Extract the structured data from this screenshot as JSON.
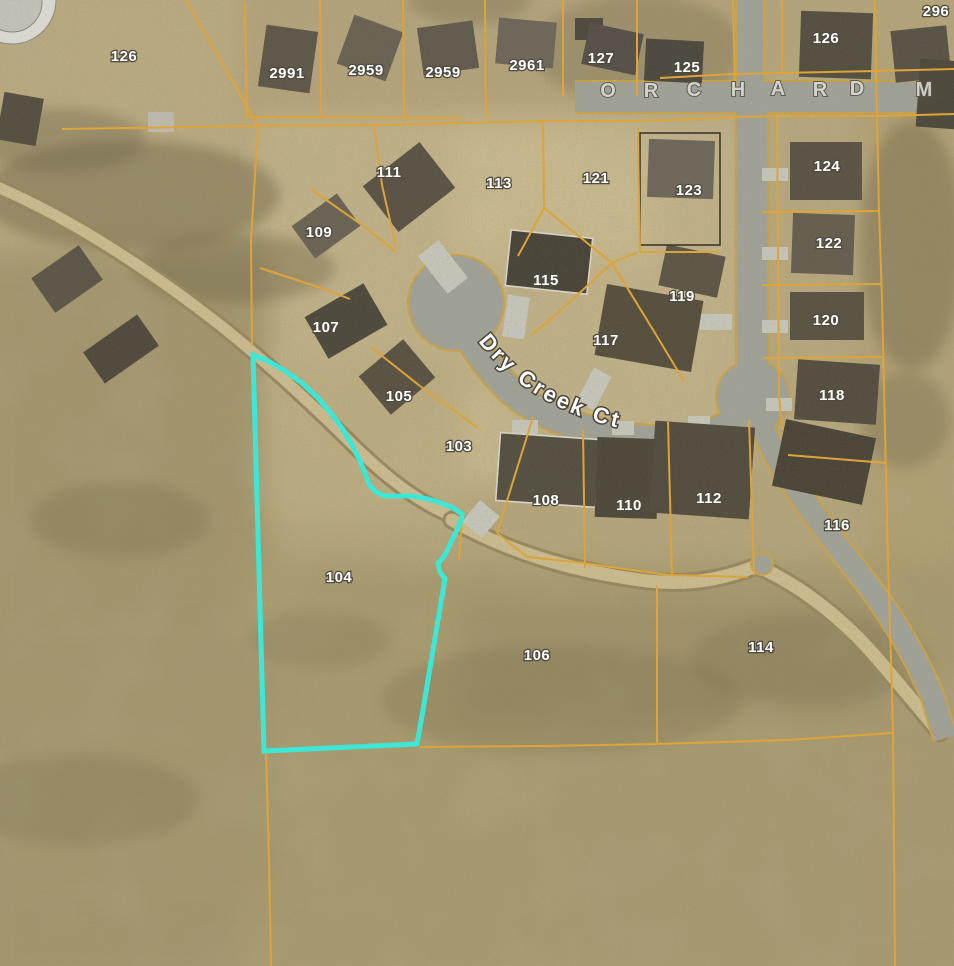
{
  "map": {
    "title": "Aerial parcel map",
    "highlight_parcel": "104",
    "street_names": {
      "court": "Dry Creek Ct",
      "main_road_visible": "O R C H A R D  M"
    },
    "colors": {
      "terrain": "#b3a47a",
      "parcel_line": "#dca43a",
      "highlight": "#3ee6d6",
      "road": "#a0a196",
      "road_edge": "#c9a24a",
      "trail_dark": "#97885f",
      "trail_light": "#c9ba8e",
      "label": "#ffffff",
      "label_halo": "#4e4a3e"
    },
    "parcel_labels": [
      {
        "text": "126",
        "x": 124,
        "y": 57
      },
      {
        "text": "2991",
        "x": 287,
        "y": 74
      },
      {
        "text": "2959",
        "x": 366,
        "y": 71
      },
      {
        "text": "2959",
        "x": 443,
        "y": 73
      },
      {
        "text": "2961",
        "x": 527,
        "y": 66
      },
      {
        "text": "127",
        "x": 601,
        "y": 59
      },
      {
        "text": "125",
        "x": 687,
        "y": 68
      },
      {
        "text": "126",
        "x": 826,
        "y": 39
      },
      {
        "text": "296",
        "x": 936,
        "y": 12
      },
      {
        "text": "111",
        "x": 389,
        "y": 173
      },
      {
        "text": "113",
        "x": 499,
        "y": 184
      },
      {
        "text": "121",
        "x": 596,
        "y": 179
      },
      {
        "text": "123",
        "x": 689,
        "y": 191
      },
      {
        "text": "124",
        "x": 827,
        "y": 167
      },
      {
        "text": "109",
        "x": 319,
        "y": 233
      },
      {
        "text": "115",
        "x": 546,
        "y": 281
      },
      {
        "text": "119",
        "x": 682,
        "y": 297
      },
      {
        "text": "122",
        "x": 829,
        "y": 244
      },
      {
        "text": "107",
        "x": 326,
        "y": 328
      },
      {
        "text": "117",
        "x": 606,
        "y": 341
      },
      {
        "text": "120",
        "x": 826,
        "y": 321
      },
      {
        "text": "105",
        "x": 399,
        "y": 397
      },
      {
        "text": "103",
        "x": 459,
        "y": 447
      },
      {
        "text": "118",
        "x": 832,
        "y": 396
      },
      {
        "text": "108",
        "x": 546,
        "y": 501
      },
      {
        "text": "110",
        "x": 629,
        "y": 506
      },
      {
        "text": "112",
        "x": 709,
        "y": 499
      },
      {
        "text": "116",
        "x": 837,
        "y": 526
      },
      {
        "text": "104",
        "x": 339,
        "y": 578
      },
      {
        "text": "106",
        "x": 537,
        "y": 656
      },
      {
        "text": "114",
        "x": 761,
        "y": 648
      }
    ],
    "orchard_letters": [
      {
        "ch": "O",
        "x": 608,
        "y": 97
      },
      {
        "ch": "R",
        "x": 651,
        "y": 97
      },
      {
        "ch": "C",
        "x": 694,
        "y": 96
      },
      {
        "ch": "H",
        "x": 738,
        "y": 96
      },
      {
        "ch": "A",
        "x": 778,
        "y": 95
      },
      {
        "ch": "R",
        "x": 820,
        "y": 96
      },
      {
        "ch": "D",
        "x": 857,
        "y": 95
      },
      {
        "ch": "M",
        "x": 924,
        "y": 96
      }
    ],
    "highlight_outline_points": "253,355 268,361 285,371 302,383 317,397 330,412 342,428 352,445 360,461 366,476 370,486 376,492 385,496 398,496 412,496 428,499 441,503 453,508 462,514 462,517 458,528 452,540 447,551 443,558 438,563 440,572 445,579 438,620 430,668 423,710 417,744 264,751",
    "parcel_lines": [
      "186,0 211,44 241,96 258,127",
      "62,129 258,126 373,125 460,123 546,121 637,121 700,119 737,117",
      "258,127 251,240 252,346",
      "245,2 247,117",
      "320,0 321,117",
      "403,0 404,118",
      "485,0 486,119",
      "563,0 563,96",
      "637,0 637,96",
      "733,0 735,96",
      "245,117 330,117 404,118 462,118",
      "660,78 733,74 876,71 954,69",
      "737,117 775,116 880,116 954,114",
      "875,0 876,70 879,210 882,300 885,430 888,560 891,660 893,732 895,966",
      "782,0 782,72",
      "762,212 880,211",
      "762,285 882,284",
      "764,358 884,357",
      "788,455 886,463",
      "777,117 778,250 779,395 782,430",
      "420,747 545,746 657,744 787,740 893,733",
      "266,751 269,860 271,966",
      "657,585 657,744",
      "374,126 382,185 396,247",
      "543,121 544,208 518,256",
      "544,208 612,263",
      "638,128 639,200 640,252",
      "612,263 638,252",
      "612,263 548,322 531,335",
      "612,263 655,333 684,381",
      "640,252 719,252",
      "312,190 362,225 396,252",
      "260,268 318,287 350,299",
      "372,348 420,386 478,428",
      "533,417 497,533",
      "583,430 585,568",
      "668,422 672,575",
      "749,420 754,575",
      "497,533 527,557 583,563 668,575 748,577",
      "462,518 459,560"
    ],
    "roads": [
      {
        "d": "M 575,97 L 954,97",
        "w": 30
      },
      {
        "d": "M 750,0 L 750,98",
        "w": 26
      },
      {
        "d": "M 752,112 L 752,300 C 752,340 753,365 753,385",
        "w": 31
      },
      {
        "d": "M 753,390 C 745,425 705,443 655,440 C 598,436 540,420 506,386 C 483,362 468,338 461,320",
        "w": 27
      },
      {
        "d": "M 763,428 C 780,470 818,522 858,572 C 888,610 915,652 934,700 L 945,738",
        "w": 22
      }
    ],
    "road_bulbs": [
      {
        "cx": 456,
        "cy": 303,
        "r": 47
      },
      {
        "cx": 753,
        "cy": 397,
        "r": 36
      },
      {
        "cx": 762,
        "cy": 564,
        "r": 10
      }
    ],
    "trails": [
      {
        "d": "M -5,186 C 70,218 150,270 220,325 C 258,355 305,398 345,437 C 372,464 408,497 447,514",
        "w": 17
      },
      {
        "d": "M 452,520 C 510,553 575,572 648,581 C 700,587 735,574 757,566 C 800,585 842,618 876,657 C 900,685 922,712 940,733",
        "w": 19
      }
    ],
    "terrain_patches": [
      {
        "x": -20,
        "y": -20,
        "w": 300,
        "h": 400,
        "fill": "#b8a980"
      },
      {
        "x": 240,
        "y": -20,
        "w": 520,
        "h": 180,
        "fill": "#b2a27a"
      },
      {
        "x": 250,
        "y": 115,
        "w": 520,
        "h": 330,
        "fill": "#bfb087"
      },
      {
        "x": 745,
        "y": 60,
        "w": 230,
        "h": 420,
        "fill": "#b5a67d"
      },
      {
        "x": -20,
        "y": 250,
        "w": 290,
        "h": 740,
        "fill": "#a2956d"
      },
      {
        "x": 860,
        "y": 60,
        "w": 120,
        "h": 920,
        "fill": "#af9f73"
      },
      {
        "x": 240,
        "y": 560,
        "w": 740,
        "h": 430,
        "fill": "#a89a6e"
      },
      {
        "x": 455,
        "y": 130,
        "w": 200,
        "h": 130,
        "fill": "#c6b78c"
      },
      {
        "x": 400,
        "y": 395,
        "w": 120,
        "h": 90,
        "fill": "#c4b58a"
      },
      {
        "x": 270,
        "y": 360,
        "w": 190,
        "h": 160,
        "fill": "#baab80"
      },
      {
        "x": 460,
        "y": 600,
        "w": 430,
        "h": 120,
        "fill": "#9f926b"
      },
      {
        "x": -20,
        "y": 640,
        "w": 300,
        "h": 250,
        "fill": "#a3966e"
      },
      {
        "x": 560,
        "y": 740,
        "w": 400,
        "h": 230,
        "fill": "#a79971"
      }
    ],
    "vegetation": [
      {
        "cx": 130,
        "cy": 195,
        "rx": 150,
        "ry": 55,
        "op": 0.45
      },
      {
        "cx": 235,
        "cy": 268,
        "rx": 100,
        "ry": 35,
        "op": 0.4
      },
      {
        "cx": 60,
        "cy": 140,
        "rx": 85,
        "ry": 32,
        "op": 0.38
      },
      {
        "cx": 640,
        "cy": 50,
        "rx": 105,
        "ry": 55,
        "op": 0.3
      },
      {
        "cx": 912,
        "cy": 245,
        "rx": 52,
        "ry": 125,
        "op": 0.4
      },
      {
        "cx": 905,
        "cy": 420,
        "rx": 45,
        "ry": 48,
        "op": 0.32
      },
      {
        "cx": 470,
        "cy": 0,
        "rx": 60,
        "ry": 25,
        "op": 0.3
      },
      {
        "cx": 560,
        "cy": 700,
        "rx": 180,
        "ry": 55,
        "op": 0.22
      },
      {
        "cx": 810,
        "cy": 660,
        "rx": 120,
        "ry": 45,
        "op": 0.22
      },
      {
        "cx": 120,
        "cy": 520,
        "rx": 90,
        "ry": 38,
        "op": 0.25
      },
      {
        "cx": 80,
        "cy": 800,
        "rx": 120,
        "ry": 45,
        "op": 0.22
      },
      {
        "cx": 320,
        "cy": 640,
        "rx": 70,
        "ry": 30,
        "op": 0.2
      }
    ],
    "buildings": [
      {
        "t": "c",
        "cx": 12,
        "cy": 0,
        "r": 44,
        "fill": "#dbdad2"
      },
      {
        "t": "c",
        "cx": 12,
        "cy": 2,
        "r": 30,
        "fill": "#c2c1b6"
      },
      {
        "t": "r",
        "x": 262,
        "y": 28,
        "w": 52,
        "h": 62,
        "rot": 8,
        "fill": "#5f584a"
      },
      {
        "t": "r",
        "x": 344,
        "y": 22,
        "w": 52,
        "h": 52,
        "rot": 20,
        "fill": "#6a6354"
      },
      {
        "t": "r",
        "x": 420,
        "y": 24,
        "w": 56,
        "h": 48,
        "rot": -8,
        "fill": "#635c4e"
      },
      {
        "t": "r",
        "x": 497,
        "y": 20,
        "w": 58,
        "h": 46,
        "rot": 5,
        "fill": "#6e675a"
      },
      {
        "t": "r",
        "x": 575,
        "y": 18,
        "w": 28,
        "h": 22,
        "rot": 0,
        "fill": "#504b40"
      },
      {
        "t": "r",
        "x": 585,
        "y": 28,
        "w": 55,
        "h": 42,
        "rot": 12,
        "fill": "#57514a"
      },
      {
        "t": "r",
        "x": 645,
        "y": 40,
        "w": 58,
        "h": 42,
        "rot": 3,
        "fill": "#4e4a40"
      },
      {
        "t": "r",
        "x": 800,
        "y": 12,
        "w": 72,
        "h": 66,
        "rot": 2,
        "fill": "#565043"
      },
      {
        "t": "r",
        "x": 893,
        "y": 28,
        "w": 56,
        "h": 52,
        "rot": -6,
        "fill": "#5a5448"
      },
      {
        "t": "r",
        "x": 918,
        "y": 60,
        "w": 40,
        "h": 68,
        "rot": 4,
        "fill": "#4f4a3e"
      },
      {
        "t": "r",
        "x": 0,
        "y": 95,
        "w": 40,
        "h": 48,
        "rot": 10,
        "fill": "#555042"
      },
      {
        "t": "r",
        "x": 148,
        "y": 112,
        "w": 26,
        "h": 20,
        "rot": 0,
        "fill": "#bdb9ac"
      },
      {
        "t": "r",
        "x": 38,
        "y": 258,
        "w": 58,
        "h": 42,
        "rot": -35,
        "fill": "#5d5749"
      },
      {
        "t": "r",
        "x": 88,
        "y": 330,
        "w": 66,
        "h": 38,
        "rot": -35,
        "fill": "#514b3f"
      },
      {
        "t": "r",
        "x": 373,
        "y": 158,
        "w": 72,
        "h": 58,
        "rot": -38,
        "fill": "#5b5446"
      },
      {
        "t": "r",
        "x": 298,
        "y": 206,
        "w": 56,
        "h": 40,
        "rot": -36,
        "fill": "#6b6456"
      },
      {
        "t": "r",
        "x": 312,
        "y": 297,
        "w": 68,
        "h": 48,
        "rot": -30,
        "fill": "#4f4a3e"
      },
      {
        "t": "r",
        "x": 368,
        "y": 352,
        "w": 58,
        "h": 50,
        "rot": -40,
        "fill": "#5a5344"
      },
      {
        "t": "r",
        "x": 508,
        "y": 234,
        "w": 82,
        "h": 56,
        "rot": 6,
        "fill": "#4a453a",
        "st": "#d8d4c6"
      },
      {
        "t": "r",
        "x": 600,
        "y": 292,
        "w": 98,
        "h": 72,
        "rot": 10,
        "fill": "#57503f"
      },
      {
        "t": "r",
        "x": 662,
        "y": 250,
        "w": 60,
        "h": 42,
        "rot": 12,
        "fill": "#5e5748"
      },
      {
        "t": "f",
        "x": 640,
        "y": 133,
        "w": 80,
        "h": 112,
        "rot": 0,
        "fill": "none",
        "st": "#3a362c"
      },
      {
        "t": "r",
        "x": 648,
        "y": 140,
        "w": 66,
        "h": 58,
        "rot": 2,
        "fill": "#6e675a"
      },
      {
        "t": "r",
        "x": 790,
        "y": 142,
        "w": 72,
        "h": 58,
        "rot": 0,
        "fill": "#5c5547"
      },
      {
        "t": "r",
        "x": 792,
        "y": 214,
        "w": 62,
        "h": 60,
        "rot": 2,
        "fill": "#665f50"
      },
      {
        "t": "r",
        "x": 790,
        "y": 292,
        "w": 74,
        "h": 48,
        "rot": 0,
        "fill": "#5a5445"
      },
      {
        "t": "r",
        "x": 796,
        "y": 362,
        "w": 82,
        "h": 60,
        "rot": 4,
        "fill": "#564f41"
      },
      {
        "t": "r",
        "x": 778,
        "y": 428,
        "w": 92,
        "h": 68,
        "rot": 12,
        "fill": "#4c4639"
      },
      {
        "t": "r",
        "x": 498,
        "y": 436,
        "w": 100,
        "h": 68,
        "rot": 4,
        "fill": "#555042",
        "st": "#d8d4c6"
      },
      {
        "t": "r",
        "x": 596,
        "y": 438,
        "w": 62,
        "h": 80,
        "rot": 2,
        "fill": "#4f4a3d"
      },
      {
        "t": "r",
        "x": 652,
        "y": 424,
        "w": 100,
        "h": 92,
        "rot": 4,
        "fill": "#544e40"
      }
    ],
    "driveways": [
      {
        "x": 430,
        "y": 243,
        "w": 26,
        "h": 48,
        "rot": -38
      },
      {
        "x": 505,
        "y": 296,
        "w": 22,
        "h": 42,
        "rot": 8
      },
      {
        "x": 584,
        "y": 370,
        "w": 20,
        "h": 38,
        "rot": 28
      },
      {
        "x": 700,
        "y": 314,
        "w": 32,
        "h": 16,
        "rot": 0
      },
      {
        "x": 762,
        "y": 168,
        "w": 26,
        "h": 13,
        "rot": 0
      },
      {
        "x": 762,
        "y": 247,
        "w": 26,
        "h": 13,
        "rot": 0
      },
      {
        "x": 762,
        "y": 320,
        "w": 26,
        "h": 13,
        "rot": 0
      },
      {
        "x": 766,
        "y": 398,
        "w": 26,
        "h": 13,
        "rot": 0
      },
      {
        "x": 512,
        "y": 420,
        "w": 26,
        "h": 14,
        "rot": 0
      },
      {
        "x": 612,
        "y": 421,
        "w": 22,
        "h": 14,
        "rot": 0
      },
      {
        "x": 688,
        "y": 416,
        "w": 22,
        "h": 14,
        "rot": 0
      },
      {
        "x": 468,
        "y": 505,
        "w": 26,
        "h": 28,
        "rot": 40
      }
    ]
  }
}
